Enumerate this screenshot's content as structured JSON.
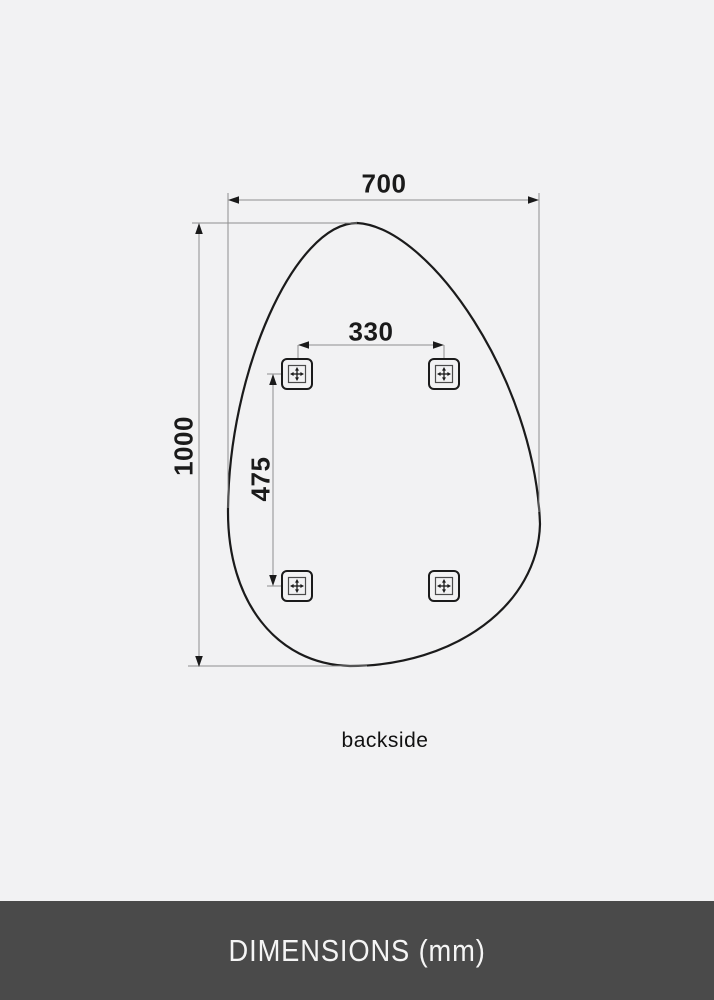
{
  "page": {
    "background_color": "#f2f2f3"
  },
  "diagram": {
    "type": "technical-dimension-drawing",
    "subject": "organic pebble-shaped mirror, rear view",
    "caption": "backside",
    "dimensions": {
      "overall_width": {
        "value": "700",
        "orientation": "horizontal"
      },
      "overall_height": {
        "value": "1000",
        "orientation": "vertical"
      },
      "bracket_spacing_horizontal": {
        "value": "330",
        "orientation": "horizontal"
      },
      "bracket_spacing_vertical": {
        "value": "475",
        "orientation": "vertical"
      }
    },
    "mount_brackets": {
      "count": 4,
      "icon": "crosshair-icon",
      "positions": [
        "top-left",
        "top-right",
        "bottom-left",
        "bottom-right"
      ]
    },
    "colors": {
      "outline": "#1b1b1b",
      "dimension_line": "#8f8f8f",
      "arrow_and_text": "#1a1a1a"
    }
  },
  "footer": {
    "label": "DIMENSIONS (mm)",
    "background_color": "#4a4a4a",
    "text_color": "#f5f5f5"
  }
}
